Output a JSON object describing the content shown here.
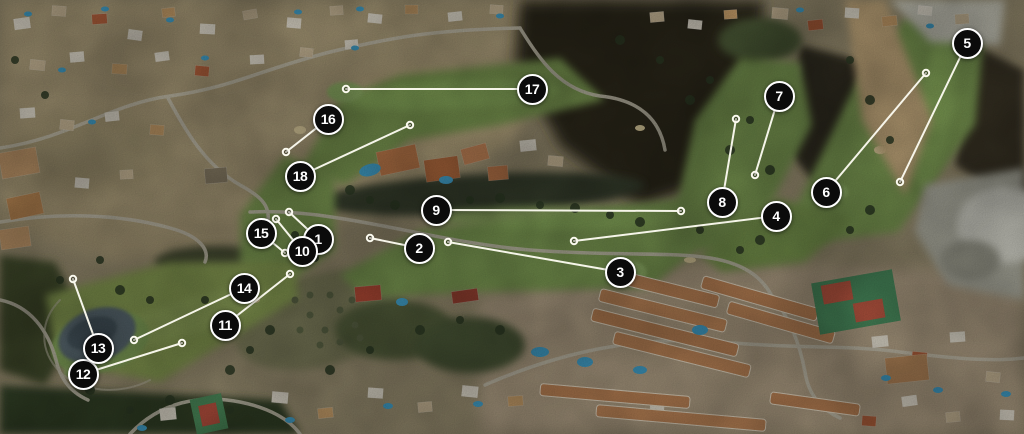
{
  "map": {
    "kind": "golf-course-satellite-hole-routing-map",
    "style": {
      "marker_background": "#0b0b0b",
      "marker_ring": "#ffffff",
      "number_color": "#ffffff",
      "line_color": "#fbfaef"
    },
    "holes": [
      {
        "number": "1",
        "marker": {
          "x": 318,
          "y": 239
        },
        "line_end": {
          "x": 289,
          "y": 212
        }
      },
      {
        "number": "2",
        "marker": {
          "x": 419,
          "y": 248
        },
        "line_end": {
          "x": 370,
          "y": 238
        }
      },
      {
        "number": "3",
        "marker": {
          "x": 620,
          "y": 272
        },
        "line_end": {
          "x": 448,
          "y": 242
        }
      },
      {
        "number": "4",
        "marker": {
          "x": 776,
          "y": 216
        },
        "line_end": {
          "x": 574,
          "y": 241
        }
      },
      {
        "number": "5",
        "marker": {
          "x": 967,
          "y": 43
        },
        "line_end": {
          "x": 900,
          "y": 182
        }
      },
      {
        "number": "6",
        "marker": {
          "x": 826,
          "y": 192
        },
        "line_end": {
          "x": 926,
          "y": 73
        }
      },
      {
        "number": "7",
        "marker": {
          "x": 779,
          "y": 96
        },
        "line_end": {
          "x": 755,
          "y": 175
        }
      },
      {
        "number": "8",
        "marker": {
          "x": 722,
          "y": 202
        },
        "line_end": {
          "x": 736,
          "y": 119
        }
      },
      {
        "number": "9",
        "marker": {
          "x": 436,
          "y": 210
        },
        "line_end": {
          "x": 681,
          "y": 211
        }
      },
      {
        "number": "10",
        "marker": {
          "x": 302,
          "y": 251
        },
        "line_end": {
          "x": 276,
          "y": 219
        }
      },
      {
        "number": "11",
        "marker": {
          "x": 225,
          "y": 325
        },
        "line_end": {
          "x": 290,
          "y": 274
        }
      },
      {
        "number": "12",
        "marker": {
          "x": 83,
          "y": 374
        },
        "line_end": {
          "x": 182,
          "y": 343
        }
      },
      {
        "number": "13",
        "marker": {
          "x": 98,
          "y": 348
        },
        "line_end": {
          "x": 73,
          "y": 279
        }
      },
      {
        "number": "14",
        "marker": {
          "x": 244,
          "y": 288
        },
        "line_end": {
          "x": 134,
          "y": 340
        }
      },
      {
        "number": "15",
        "marker": {
          "x": 261,
          "y": 233
        },
        "line_end": {
          "x": 285,
          "y": 253
        }
      },
      {
        "number": "16",
        "marker": {
          "x": 328,
          "y": 119
        },
        "line_end": {
          "x": 286,
          "y": 152
        }
      },
      {
        "number": "17",
        "marker": {
          "x": 532,
          "y": 89
        },
        "line_end": {
          "x": 346,
          "y": 89
        }
      },
      {
        "number": "18",
        "marker": {
          "x": 300,
          "y": 176
        },
        "line_end": {
          "x": 410,
          "y": 125
        }
      }
    ]
  }
}
